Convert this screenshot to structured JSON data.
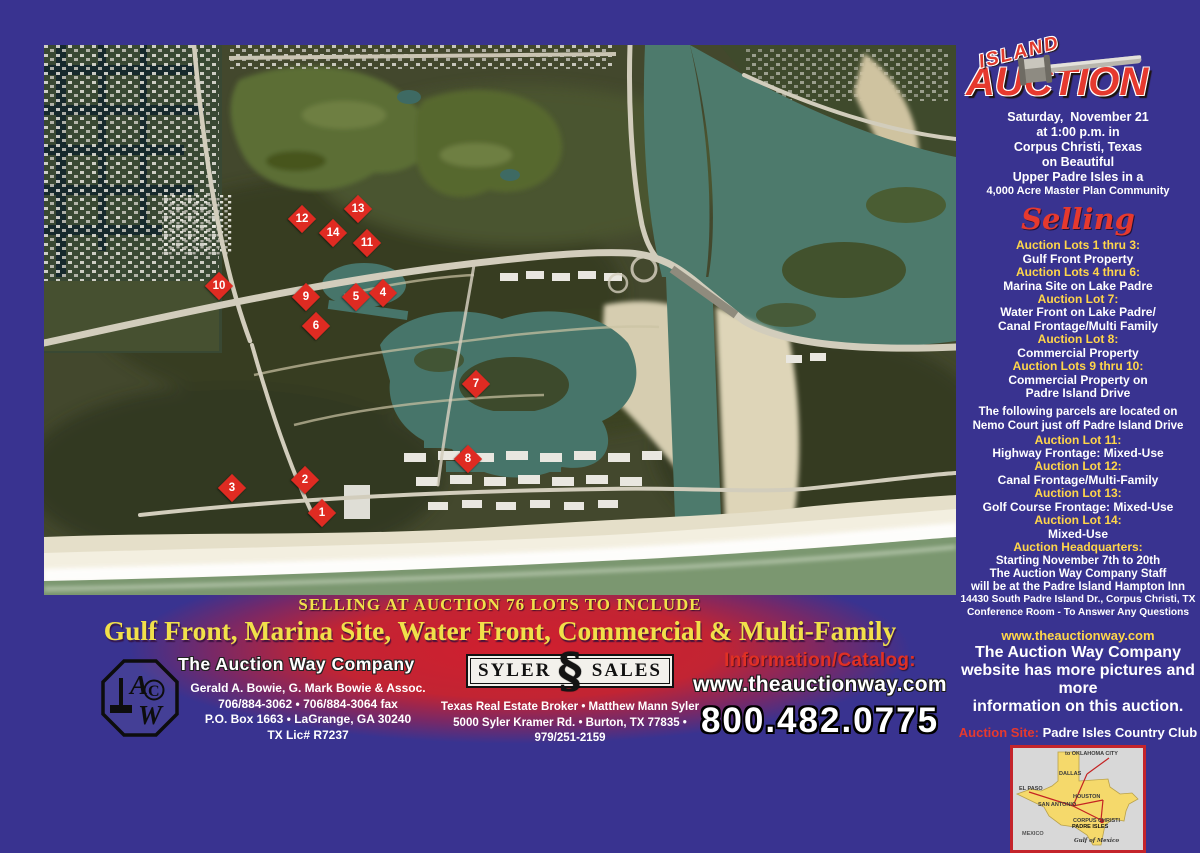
{
  "colors": {
    "background_purple": "#393390",
    "accent_red": "#e6392e",
    "accent_yellow": "#ffd64a",
    "banner_yellow": "#f1e04a",
    "marker_red": "#df2b22"
  },
  "event": {
    "island": "ISLAND",
    "auction": "AUCTION",
    "gavel_icon": "gavel-icon",
    "date_lines": [
      "Saturday,  November 21",
      "at 1:00 p.m. in",
      "Corpus Christi, Texas",
      "on Beautiful",
      "Upper Padre Isles in a",
      "4,000 Acre Master Plan Community"
    ]
  },
  "selling": {
    "heading": "Selling",
    "groups": [
      {
        "title": "Auction Lots 1 thru 3:",
        "lines": [
          "Gulf Front Property"
        ]
      },
      {
        "title": "Auction Lots 4 thru 6:",
        "lines": [
          "Marina Site on Lake Padre"
        ]
      },
      {
        "title": "Auction Lot 7:",
        "lines": [
          "Water Front on Lake Padre/",
          "Canal Frontage/Multi Family"
        ]
      },
      {
        "title": "Auction Lot 8:",
        "lines": [
          "Commercial Property"
        ]
      },
      {
        "title": "Auction Lots 9 thru 10:",
        "lines": [
          "Commercial Property on",
          "Padre Island Drive"
        ]
      }
    ],
    "nemo_note": [
      "The following parcels are located on",
      "Nemo Court just off Padre Island Drive"
    ],
    "groups2": [
      {
        "title": "Auction Lot 11:",
        "lines": [
          "Highway Frontage: Mixed-Use"
        ]
      },
      {
        "title": "Auction Lot 12:",
        "lines": [
          "Canal Frontage/Multi-Family"
        ]
      },
      {
        "title": "Auction Lot 13:",
        "lines": [
          "Golf Course Frontage: Mixed-Use"
        ]
      },
      {
        "title": "Auction Lot 14:",
        "lines": [
          "Mixed-Use"
        ]
      }
    ],
    "headquarters": {
      "title": "Auction Headquarters:",
      "lines": [
        "Starting November 7th to 20th",
        "The Auction Way Company Staff",
        "will be at the Padre Island Hampton Inn",
        "14430 South Padre Island Dr., Corpus Christi, TX",
        "Conference Room - To Answer Any Questions"
      ]
    }
  },
  "website_block": {
    "url": "www.theauctionway.com",
    "lines": [
      "The Auction Way Company",
      "website has more pictures and more",
      "information on this auction."
    ]
  },
  "auction_site": {
    "label": "Auction Site:",
    "value": "Padre Isles Country Club"
  },
  "texas_map": {
    "cities": [
      {
        "label": "to OKLAHOMA CITY",
        "x": 52,
        "y": 3,
        "cls": "tiny"
      },
      {
        "label": "DALLAS",
        "x": 46,
        "y": 23,
        "cls": "city"
      },
      {
        "label": "EL PASO",
        "x": 6,
        "y": 38,
        "cls": "city"
      },
      {
        "label": "SAN ANTONIO",
        "x": 25,
        "y": 54,
        "cls": "city"
      },
      {
        "label": "HOUSTON",
        "x": 60,
        "y": 46,
        "cls": "city"
      },
      {
        "label": "CORPUS CHRISTI",
        "x": 60,
        "y": 70,
        "cls": "tiny"
      },
      {
        "label": "PADRE ISLES",
        "x": 59,
        "y": 76,
        "cls": "big"
      },
      {
        "label": "MEXICO",
        "x": 9,
        "y": 83,
        "cls": "mexico"
      },
      {
        "label": "Gulf of Mexico",
        "x": 61,
        "y": 90,
        "cls": "gulf"
      }
    ]
  },
  "banner": {
    "line1": "SELLING AT AUCTION 76 LOTS TO INCLUDE",
    "line2": "Gulf Front, Marina Site, Water Front, Commercial & Multi-Family"
  },
  "footer": {
    "acw": {
      "monogram": "ACW",
      "company": "The Auction Way Company",
      "lines": [
        "Gerald  A. Bowie, G. Mark Bowie & Assoc.",
        "706/884-3062  •  706/884-3064 fax",
        "P.O. Box 1663  •  LaGrange, GA 30240",
        "TX Lic# R7237"
      ]
    },
    "syler": {
      "word_left": "SYLER",
      "word_right": "SALES",
      "lines": [
        "Texas Real Estate Broker  •  Matthew Mann  Syler",
        "5000 Syler Kramer Rd.  •  Burton, TX 77835  •  979/251-2159"
      ]
    },
    "contact": {
      "label": "Information/Catalog:",
      "url": "www.theauctionway.com",
      "phone": "800.482.0775"
    }
  },
  "map": {
    "markers": [
      {
        "n": "1",
        "x": 278,
        "y": 468
      },
      {
        "n": "2",
        "x": 261,
        "y": 435
      },
      {
        "n": "3",
        "x": 188,
        "y": 443
      },
      {
        "n": "4",
        "x": 339,
        "y": 248
      },
      {
        "n": "5",
        "x": 312,
        "y": 252
      },
      {
        "n": "6",
        "x": 272,
        "y": 281
      },
      {
        "n": "7",
        "x": 432,
        "y": 339
      },
      {
        "n": "8",
        "x": 424,
        "y": 414
      },
      {
        "n": "9",
        "x": 262,
        "y": 252
      },
      {
        "n": "10",
        "x": 175,
        "y": 241
      },
      {
        "n": "11",
        "x": 323,
        "y": 198
      },
      {
        "n": "12",
        "x": 258,
        "y": 174
      },
      {
        "n": "13",
        "x": 314,
        "y": 164
      },
      {
        "n": "14",
        "x": 289,
        "y": 188
      }
    ]
  }
}
